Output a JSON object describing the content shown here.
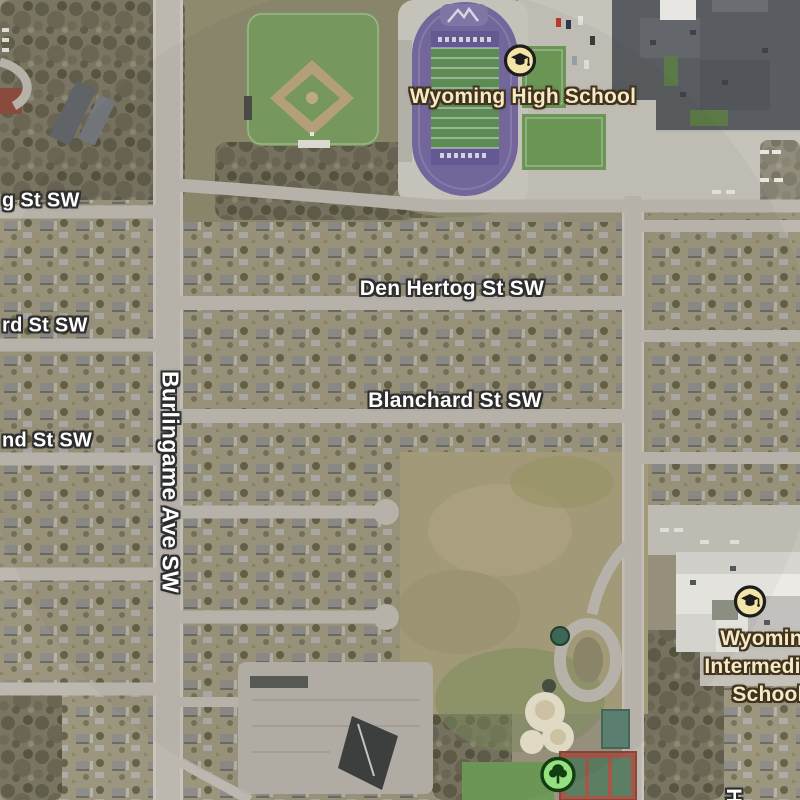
{
  "map": {
    "view": "satellite",
    "streets": {
      "g_partial": "g St SW",
      "rd_partial": "rd St SW",
      "nd_partial": "nd St SW",
      "burlingame": "Burlingame Ave SW",
      "den_hertog": "Den Hertog St SW",
      "blanchard": "Blanchard St SW",
      "h_partial": "H"
    },
    "pois": {
      "high_school": {
        "name": "Wyoming High School",
        "icon": "school-icon"
      },
      "intermediate_school": {
        "name": "Wyoming Intermediate School",
        "line1": "Wyoming",
        "line2": "Intermediate",
        "line3": "School",
        "icon": "school-icon"
      },
      "park": {
        "icon": "tree-icon"
      }
    },
    "colors": {
      "street_label": "#ffffff",
      "street_label_outline": "#2d2d2d",
      "poi_label": "#f6e9c5",
      "poi_label_outline": "#40311c",
      "school_icon_bg": "#f3e4a8",
      "school_icon_glyph": "#1d1d1d",
      "park_icon_bg": "#97e07f",
      "park_icon_glyph": "#123f12",
      "stadium_track_purple": "#776aa1",
      "football_field_green": "#5f9156",
      "road_gray": "#bcb8af"
    }
  }
}
